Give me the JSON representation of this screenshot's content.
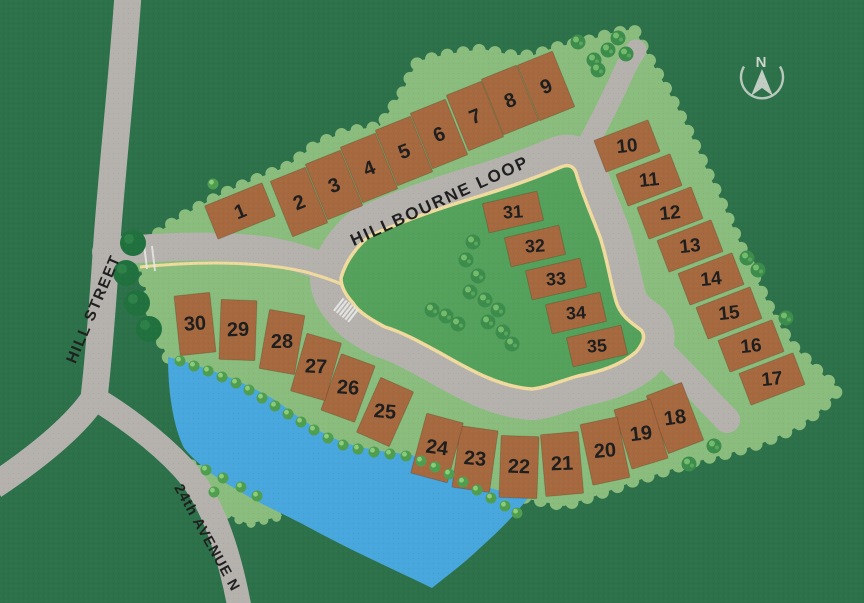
{
  "compass": {
    "label": "N"
  },
  "streets": {
    "loop": "HILLBOURNE LOOP",
    "hill": "HILL STREET",
    "ave": "24th AVENUE N"
  },
  "lots": [
    "1",
    "2",
    "3",
    "4",
    "5",
    "6",
    "7",
    "8",
    "9",
    "10",
    "11",
    "12",
    "13",
    "14",
    "15",
    "16",
    "17",
    "18",
    "19",
    "20",
    "21",
    "22",
    "23",
    "24",
    "25",
    "26",
    "27",
    "28",
    "29",
    "30",
    "31",
    "32",
    "33",
    "34",
    "35"
  ],
  "colors": {
    "background": "#2c7149",
    "parcel": "#8abd7d",
    "island": "#54a15c",
    "road": "#b5b2ae",
    "road_edge_line": "#f0da9e",
    "lot": "#a6693f",
    "lot_number": "#1e1e1e",
    "pond": "#48a7dd",
    "label_text": "#1f1f1f",
    "compass": "#c9d2c9"
  }
}
